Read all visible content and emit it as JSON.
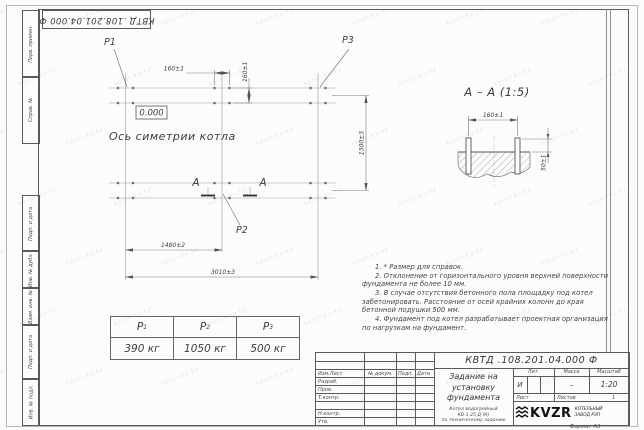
{
  "sheet": {
    "doc_number_stamp": "КВТД .108.201.04.000  Ф",
    "watermark": "kotel-kv.kz",
    "format_label": "Формат А3"
  },
  "side_strip": {
    "top": [
      "Перв. примен.",
      "Справ. №"
    ],
    "bottom": [
      "Подп. и дата",
      "Инв. № дубл.",
      "Взам. инв. №",
      "Подп. и дата",
      "Инв. № подл."
    ]
  },
  "plan": {
    "elevation": "0.000",
    "axis_label": "Ось симетрии котла",
    "section_letter": "А",
    "labels": {
      "p1": "Р1",
      "p2": "Р2",
      "p3": "Р3"
    },
    "dims": {
      "bolt_spacing_x": "160±1",
      "bolt_spacing_y": "160±1",
      "width": "1300±3",
      "left_span": "1480±2",
      "total_span": "3010±3"
    }
  },
  "section": {
    "title": "А – А (1:5)",
    "dims": {
      "spacing": "160±1",
      "protrusion": "50±1"
    }
  },
  "load_table": {
    "headers": [
      {
        "sym": "Р",
        "sub": "1"
      },
      {
        "sym": "Р",
        "sub": "2"
      },
      {
        "sym": "Р",
        "sub": "3"
      }
    ],
    "values": [
      "390 кг",
      "1050 кг",
      "500 кг"
    ]
  },
  "notes": [
    "1. * Размер для справок.",
    "2. Отклонение от горизонтального уровня верхней поверхности фундамента не более 10 мм.",
    "3. В случае отсутствия бетонного пола площадку под котел забетонировать. Расстояние от осей крайних колонн до края бетонной подушки 500 мм.",
    "4. Фундамент под котел разрабатывает проектная организация по нагрузкам на фундамент."
  ],
  "title_block": {
    "designation": "КВТД .108.201.04.000  Ф",
    "title_lines": [
      "Задание на",
      "установку",
      "фундамента"
    ],
    "subtitle_lines": [
      "Котел водогрейный",
      "КВ-1,25 Д (К)",
      "по техническому заданию"
    ],
    "header_cols": [
      "Изм.Лист",
      "№ докум.",
      "Подп.",
      "Дата"
    ],
    "row_labels": [
      "Разраб.",
      "Пров.",
      "Т.контр.",
      "",
      "Н.контр.",
      "Утв."
    ],
    "lit_header": "Лит.",
    "mass_header": "Масса",
    "scale_header": "Масштаб",
    "lit_value": "И",
    "mass_value": "–",
    "scale_value": "1:20",
    "sheet_label": "Лист",
    "sheets_label": "Листов",
    "sheets_value": "1",
    "company": {
      "logo": "KVZR",
      "name_line1": "КОТЕЛЬНЫЙ",
      "name_line2": "ЗАВОД РЭП"
    }
  }
}
